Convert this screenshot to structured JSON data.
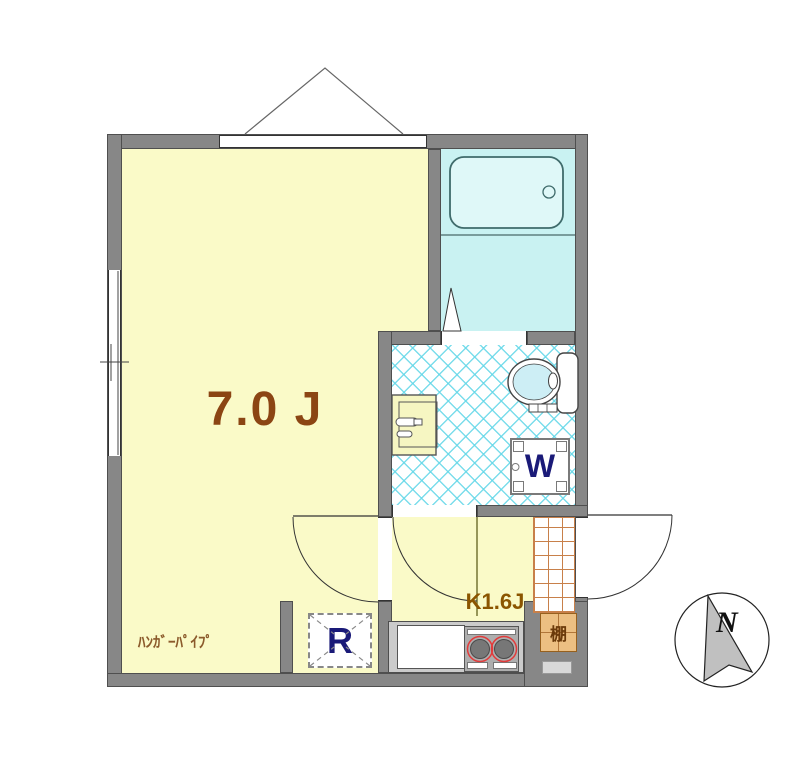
{
  "plan": {
    "rooms": {
      "main_room": {
        "label": "7.0 J"
      },
      "kitchen": {
        "label": "K1.6J"
      },
      "hanger_pipe": {
        "label": "ﾊﾝｶﾞｰﾊﾟｲﾌﾟ"
      },
      "refrigerator_space": {
        "label": "R"
      },
      "washer_space": {
        "label": "W"
      },
      "shelf": {
        "label": "棚"
      }
    },
    "fixtures": [
      "bathtub",
      "toilet",
      "vanity-sink",
      "kitchen-counter",
      "two-burner-stove"
    ],
    "compass": {
      "label": "N"
    },
    "colors": {
      "wall": "#878787",
      "room_floor": "#fafac8",
      "bath_floor": "#c9f2f2",
      "tile_grid_line": "#c8804a",
      "hatch_line": "#64d7e8",
      "room_label": "#8b4513",
      "kitchen_label": "#8b5500",
      "navy_letter": "#1a1a78",
      "shelf_fill": "#ecbf82",
      "burner_ring": "#e23b3b"
    }
  }
}
